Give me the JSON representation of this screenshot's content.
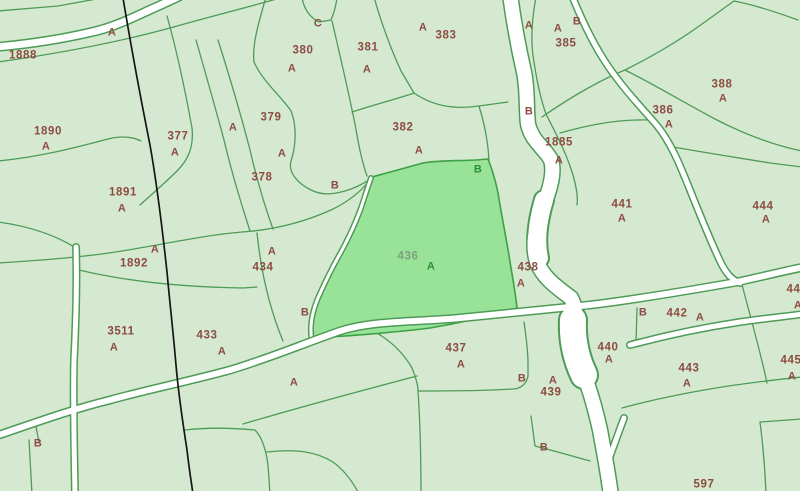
{
  "map": {
    "type": "cadastral-parcel-map",
    "selected_parcel": "436",
    "colors": {
      "background": "#d5e9d0",
      "boundary": "#4e9b57",
      "road_fill": "#ffffff",
      "highlight_fill": "#98e398",
      "highlight_border": "#3da045",
      "label_brown": "#8d4b42",
      "label_green": "#2e8f35",
      "label_sage": "#7fa080",
      "survey_line": "#161616"
    },
    "labels": [
      {
        "text": "1888",
        "x": 23,
        "y": 56,
        "kind": "num"
      },
      {
        "text": "A",
        "x": 112,
        "y": 33,
        "kind": "ltr"
      },
      {
        "text": "1890",
        "x": 48,
        "y": 132,
        "kind": "num"
      },
      {
        "text": "A",
        "x": 46,
        "y": 147,
        "kind": "ltr"
      },
      {
        "text": "377",
        "x": 178,
        "y": 137,
        "kind": "num"
      },
      {
        "text": "A",
        "x": 175,
        "y": 153,
        "kind": "ltr"
      },
      {
        "text": "A",
        "x": 233,
        "y": 128,
        "kind": "ltr"
      },
      {
        "text": "379",
        "x": 271,
        "y": 118,
        "kind": "num"
      },
      {
        "text": "A",
        "x": 282,
        "y": 154,
        "kind": "ltr"
      },
      {
        "text": "378",
        "x": 262,
        "y": 178,
        "kind": "num"
      },
      {
        "text": "380",
        "x": 303,
        "y": 51,
        "kind": "num"
      },
      {
        "text": "A",
        "x": 292,
        "y": 69,
        "kind": "ltr"
      },
      {
        "text": "C",
        "x": 318,
        "y": 24,
        "kind": "ltr"
      },
      {
        "text": "381",
        "x": 368,
        "y": 48,
        "kind": "num"
      },
      {
        "text": "A",
        "x": 367,
        "y": 70,
        "kind": "ltr"
      },
      {
        "text": "A",
        "x": 423,
        "y": 28,
        "kind": "ltr"
      },
      {
        "text": "383",
        "x": 446,
        "y": 36,
        "kind": "num"
      },
      {
        "text": "382",
        "x": 403,
        "y": 128,
        "kind": "num"
      },
      {
        "text": "A",
        "x": 419,
        "y": 151,
        "kind": "ltr"
      },
      {
        "text": "B",
        "x": 335,
        "y": 186,
        "kind": "ltr"
      },
      {
        "text": "A",
        "x": 529,
        "y": 26,
        "kind": "ltr"
      },
      {
        "text": "A",
        "x": 558,
        "y": 29,
        "kind": "ltr"
      },
      {
        "text": "B",
        "x": 577,
        "y": 22,
        "kind": "ltr"
      },
      {
        "text": "385",
        "x": 566,
        "y": 44,
        "kind": "num"
      },
      {
        "text": "B",
        "x": 529,
        "y": 112,
        "kind": "ltr"
      },
      {
        "text": "1885",
        "x": 559,
        "y": 143,
        "kind": "num"
      },
      {
        "text": "A",
        "x": 559,
        "y": 161,
        "kind": "ltr"
      },
      {
        "text": "386",
        "x": 663,
        "y": 111,
        "kind": "num"
      },
      {
        "text": "A",
        "x": 669,
        "y": 125,
        "kind": "ltr"
      },
      {
        "text": "388",
        "x": 722,
        "y": 85,
        "kind": "num"
      },
      {
        "text": "A",
        "x": 723,
        "y": 99,
        "kind": "ltr"
      },
      {
        "text": "441",
        "x": 622,
        "y": 205,
        "kind": "num"
      },
      {
        "text": "A",
        "x": 622,
        "y": 219,
        "kind": "ltr"
      },
      {
        "text": "444",
        "x": 763,
        "y": 207,
        "kind": "num"
      },
      {
        "text": "A",
        "x": 766,
        "y": 220,
        "kind": "ltr"
      },
      {
        "text": "1891",
        "x": 123,
        "y": 193,
        "kind": "num"
      },
      {
        "text": "A",
        "x": 122,
        "y": 209,
        "kind": "ltr"
      },
      {
        "text": "A",
        "x": 155,
        "y": 250,
        "kind": "ltr"
      },
      {
        "text": "1892",
        "x": 134,
        "y": 264,
        "kind": "num"
      },
      {
        "text": "A",
        "x": 272,
        "y": 252,
        "kind": "ltr"
      },
      {
        "text": "434",
        "x": 263,
        "y": 268,
        "kind": "num"
      },
      {
        "text": "436",
        "x": 408,
        "y": 257,
        "kind": "num-selected"
      },
      {
        "text": "A",
        "x": 431,
        "y": 267,
        "kind": "ltr-selected"
      },
      {
        "text": "B",
        "x": 478,
        "y": 170,
        "kind": "ltr-selected"
      },
      {
        "text": "438",
        "x": 528,
        "y": 268,
        "kind": "num"
      },
      {
        "text": "A",
        "x": 521,
        "y": 284,
        "kind": "ltr"
      },
      {
        "text": "B",
        "x": 305,
        "y": 313,
        "kind": "ltr"
      },
      {
        "text": "3511",
        "x": 121,
        "y": 332,
        "kind": "num"
      },
      {
        "text": "A",
        "x": 114,
        "y": 348,
        "kind": "ltr"
      },
      {
        "text": "433",
        "x": 207,
        "y": 336,
        "kind": "num"
      },
      {
        "text": "A",
        "x": 222,
        "y": 352,
        "kind": "ltr"
      },
      {
        "text": "B",
        "x": 38,
        "y": 444,
        "kind": "ltr"
      },
      {
        "text": "A",
        "x": 294,
        "y": 383,
        "kind": "ltr"
      },
      {
        "text": "437",
        "x": 456,
        "y": 349,
        "kind": "num"
      },
      {
        "text": "A",
        "x": 461,
        "y": 365,
        "kind": "ltr"
      },
      {
        "text": "B",
        "x": 522,
        "y": 379,
        "kind": "ltr"
      },
      {
        "text": "A",
        "x": 553,
        "y": 381,
        "kind": "ltr"
      },
      {
        "text": "439",
        "x": 551,
        "y": 393,
        "kind": "num"
      },
      {
        "text": "B",
        "x": 544,
        "y": 448,
        "kind": "ltr"
      },
      {
        "text": "440",
        "x": 608,
        "y": 348,
        "kind": "num"
      },
      {
        "text": "A",
        "x": 609,
        "y": 360,
        "kind": "ltr"
      },
      {
        "text": "B",
        "x": 643,
        "y": 313,
        "kind": "ltr"
      },
      {
        "text": "442",
        "x": 677,
        "y": 314,
        "kind": "num"
      },
      {
        "text": "A",
        "x": 700,
        "y": 318,
        "kind": "ltr"
      },
      {
        "text": "443",
        "x": 689,
        "y": 369,
        "kind": "num"
      },
      {
        "text": "A",
        "x": 687,
        "y": 384,
        "kind": "ltr"
      },
      {
        "text": "445",
        "x": 791,
        "y": 361,
        "kind": "num"
      },
      {
        "text": "A",
        "x": 792,
        "y": 377,
        "kind": "ltr"
      },
      {
        "text": "444",
        "x": 797,
        "y": 290,
        "kind": "num"
      },
      {
        "text": "A",
        "x": 798,
        "y": 306,
        "kind": "ltr"
      },
      {
        "text": "597",
        "x": 704,
        "y": 485,
        "kind": "num"
      }
    ]
  }
}
